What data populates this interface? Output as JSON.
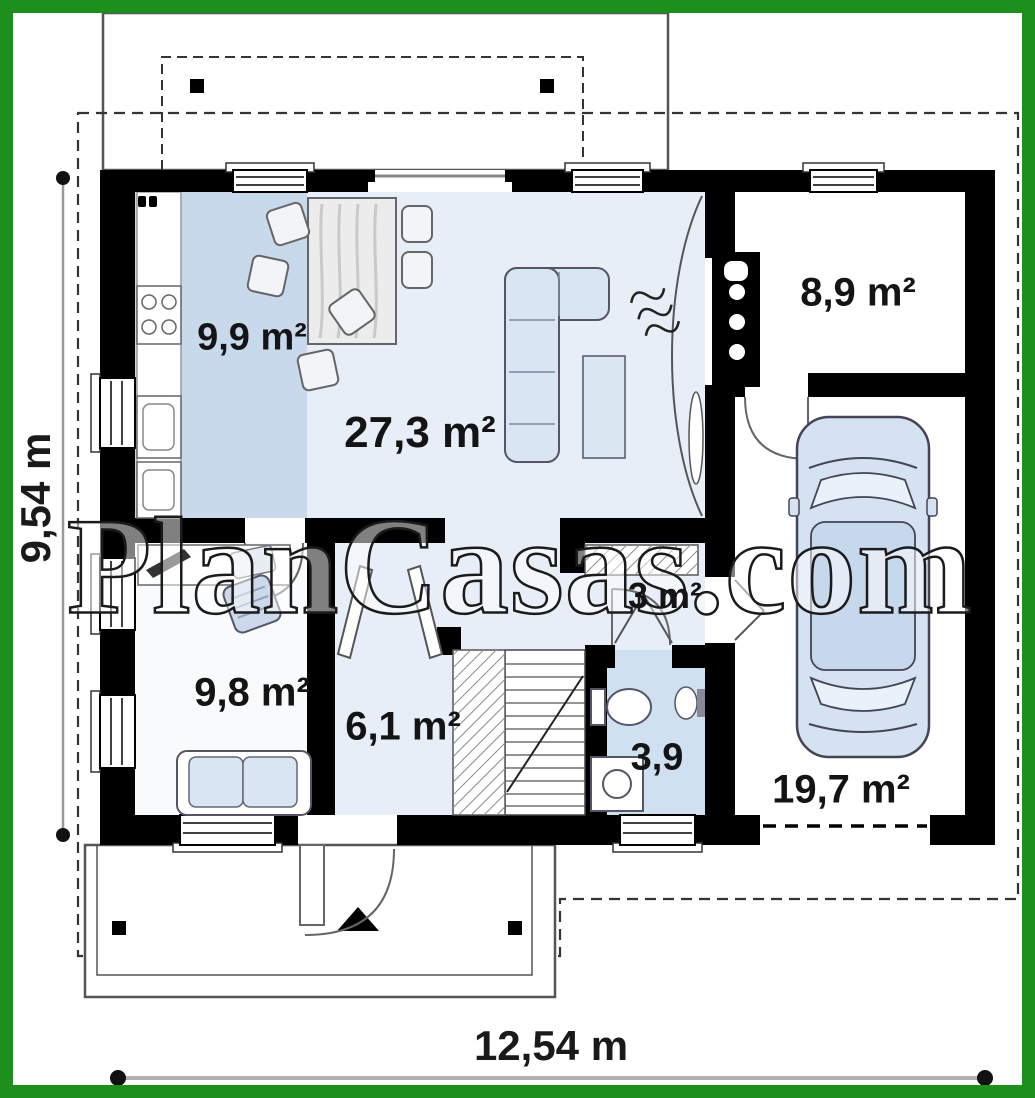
{
  "watermark_text": "PlanCasas.com",
  "dimensions": {
    "bottom": "12,54 m",
    "left": "9,54 m"
  },
  "rooms": {
    "kitchen": {
      "area_label": "9,9 m²"
    },
    "living": {
      "area_label": "27,3 m²"
    },
    "utility": {
      "area_label": "8,9 m²"
    },
    "closet": {
      "area_label": "3 m²"
    },
    "bedroom": {
      "area_label": "9,8 m²"
    },
    "hall": {
      "area_label": "6,1 m²"
    },
    "bathroom": {
      "area_label": "3,9"
    },
    "garage": {
      "area_label": "19,7 m²"
    }
  },
  "colors": {
    "frame": "#1d8f1d",
    "wall": "#000000",
    "kitchen_floor": "#c8d9ec",
    "living_floor": "#e7eef8",
    "bath_floor": "#cfe0f1",
    "bedroom_floor": "#f8fafc",
    "furniture_blue": "#d9e5f3",
    "label_color": "#141414"
  }
}
